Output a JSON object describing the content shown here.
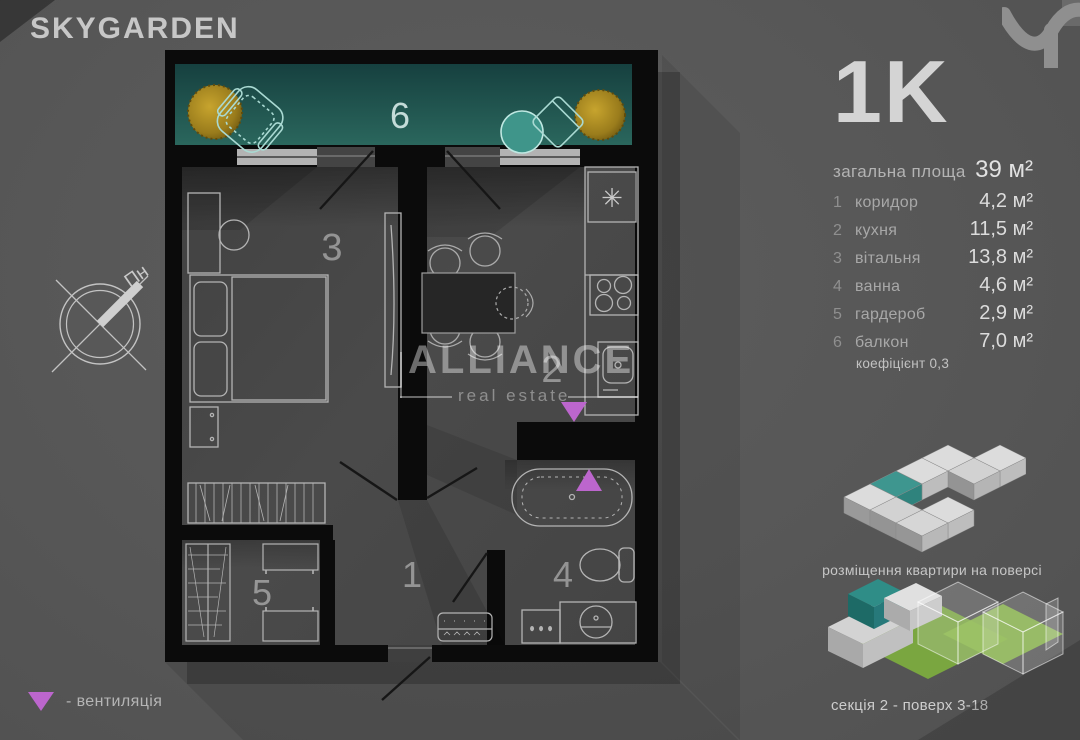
{
  "brand": "SKYGARDEN",
  "panel": {
    "type_label": "1K",
    "total": {
      "label": "загальна площа",
      "value": "39 м²"
    },
    "rooms": [
      {
        "num": "1",
        "name": "коридор",
        "area": "4,2 м²"
      },
      {
        "num": "2",
        "name": "кухня",
        "area": "11,5 м²"
      },
      {
        "num": "3",
        "name": "вітальня",
        "area": "13,8 м²"
      },
      {
        "num": "4",
        "name": "ванна",
        "area": "4,6 м²"
      },
      {
        "num": "5",
        "name": "гардероб",
        "area": "2,9 м²"
      },
      {
        "num": "6",
        "name": "балкон",
        "area": "7,0 м²"
      }
    ],
    "coefficient": "коефіцієнт 0,3"
  },
  "plan": {
    "labels": {
      "r1": "1",
      "r2": "2",
      "r3": "3",
      "r4": "4",
      "r5": "5",
      "r6": "6"
    },
    "fridge_symbol": "✳",
    "watermark": {
      "title": "ALLIANCE",
      "subtitle": "real estate"
    }
  },
  "compass": {
    "north": "Пн"
  },
  "legend": {
    "ventilation": "- вентиляція"
  },
  "thumbnails": {
    "floor_caption": "розміщення квартири на поверсі",
    "section_caption": "секція 2 - поверх 3-18"
  },
  "colors": {
    "background": "#575757",
    "wall": "#0b0b0b",
    "floor": "#464646",
    "balcony_teal": "#235a55",
    "accent_violet": "#bc66cd",
    "plant_gold": "#b39122",
    "panel_text": "#d8d8d8",
    "muted_text": "#a8a8a8"
  }
}
